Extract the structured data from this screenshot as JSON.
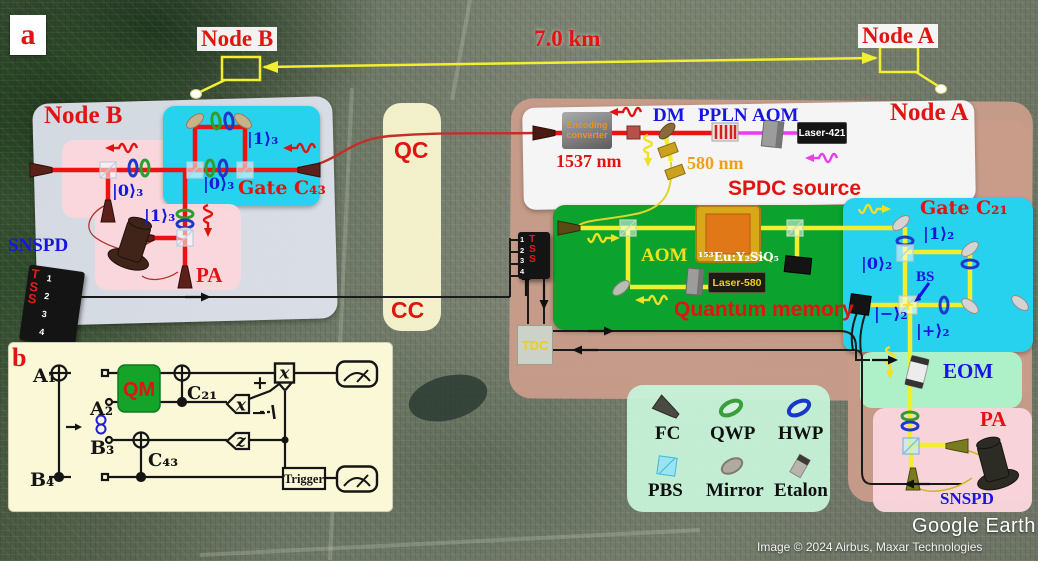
{
  "panel_a_tag": "a",
  "panel_b_tag": "b",
  "map": {
    "node_b": "Node B",
    "node_a": "Node A",
    "distance": "7.0 km",
    "credit_brand": "Google Earth",
    "credit_line": "Image © 2024 Airbus, Maxar Technologies"
  },
  "node_b": {
    "title": "Node B",
    "snspd": "SNSPD",
    "pa": "PA",
    "gate": "Gate C₄₃",
    "ket1_gate": "|1⟩₃",
    "ket0_gate": "|0⟩₃",
    "ket0_pink": "|0⟩₃",
    "ket1_pa": "|1⟩₃",
    "tss": "TSS",
    "ch1": "1",
    "ch2": "2",
    "ch3": "3",
    "ch4": "4"
  },
  "links": {
    "qc": "QC",
    "cc": "CC"
  },
  "node_a": {
    "title": "Node A",
    "spdc": {
      "title": "SPDC source",
      "encoding": "Encoding converter",
      "dm": "DM",
      "ppln": "PPLN",
      "aom": "AOM",
      "laser": "Laser-421",
      "wl_signal": "1537 nm",
      "wl_memory": "580 nm"
    },
    "memory": {
      "title": "Quantum memory",
      "aom": "AOM",
      "crystal": "¹⁵³Eu:Y₂SiO₅",
      "laser": "Laser-580"
    },
    "gate": {
      "title": "Gate C₂₁",
      "ket1": "|1⟩₂",
      "ket0": "|0⟩₂",
      "bs": "BS",
      "ket_minus": "|−⟩₂",
      "ket_plus": "|+⟩₂"
    },
    "eom": "EOM",
    "pa": "PA",
    "snspd": "SNSPD",
    "tss": "TSS",
    "ch1": "1",
    "ch2": "2",
    "ch3": "3",
    "ch4": "4",
    "tdc": "TDC"
  },
  "legend": {
    "fc": "FC",
    "qwp": "QWP",
    "hwp": "HWP",
    "pbs": "PBS",
    "mirror": "Mirror",
    "etalon": "Etalon"
  },
  "circuit": {
    "q1": "A₁",
    "q2": "A₂",
    "q3": "B₃",
    "q4": "B₄",
    "qm": "QM",
    "c21": "C₂₁",
    "c43": "C₄₃",
    "x_box": "x",
    "x_meas": "x",
    "z_meas": "z",
    "plus": "+",
    "minus": "−",
    "trigger": "Trigger"
  }
}
